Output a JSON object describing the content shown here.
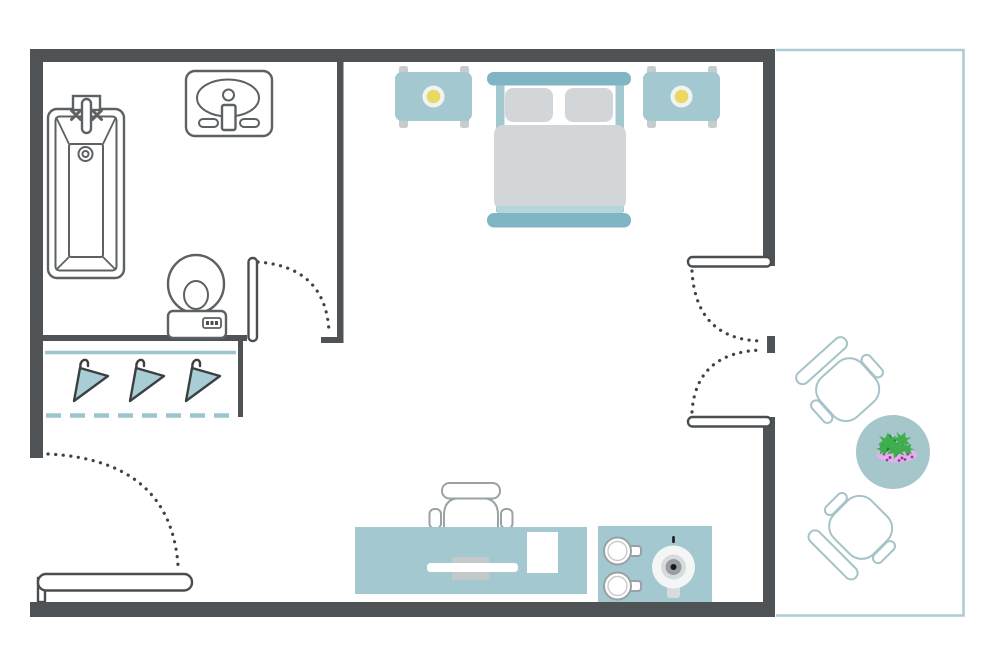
{
  "diagram": {
    "type": "floor-plan",
    "text_labels": []
  },
  "colors": {
    "wall": "#4f5356",
    "outline": "#5d6163",
    "door-outline": "#4a4e50",
    "dots": "#3f4345",
    "furniture": "#a3c8d0",
    "bedframe": "#80b6c4",
    "bedding": "#d3d6d8",
    "accent-strip": "#b7d6db",
    "lamp": "#e9d861",
    "lamp-base": "#f1f3f3",
    "legs": "#c7cdcf",
    "closet-line": "#9cc5cd",
    "hanger": "#a9cdd4",
    "hanger-outline": "#3c4042",
    "chair-outline": "#9aa2a6",
    "cup-outline": "#9aa1a4",
    "desk-tray-shadow": "#c3c9cb",
    "kettle-body": "#f4f5f5",
    "kettle-ring": "#d8dbdc",
    "kettle-mid": "#979da0",
    "kettle-dark": "#17191b",
    "balcony-line": "#abccd2",
    "patio-outline": "#a5c3c8",
    "patio-table": "#a5c6cb",
    "plant-green": "#3fae4e",
    "plant-green-dark": "#20813a",
    "plant-pot": "#e5b0e8",
    "plant-dot": "#8b3fa0"
  },
  "rooms": {
    "bathroom": {
      "fixtures": [
        "bathtub",
        "sink-vanity",
        "toilet"
      ],
      "door_count": 1
    },
    "closet": {
      "hanger_count": 3,
      "rail": "solid-line",
      "front": "dashed-line"
    },
    "main_room": {
      "furniture": [
        "double-bed",
        "nightstand-left",
        "nightstand-right",
        "desk",
        "office-chair",
        "kitchenette-counter"
      ],
      "pillow_count": 2,
      "lamp_count": 2
    },
    "kitchenette": {
      "cup_count": 2,
      "kettle_count": 1
    },
    "balcony": {
      "chair_count": 2,
      "table_count": 1,
      "plant_count": 1
    }
  },
  "doors": {
    "entrance": {
      "type": "single-swing",
      "location": "bottom-left"
    },
    "bathroom": {
      "type": "single-swing",
      "location": "bathroom-wall"
    },
    "balcony": {
      "type": "double-french",
      "leaf_count": 2,
      "location": "right-wall"
    }
  }
}
